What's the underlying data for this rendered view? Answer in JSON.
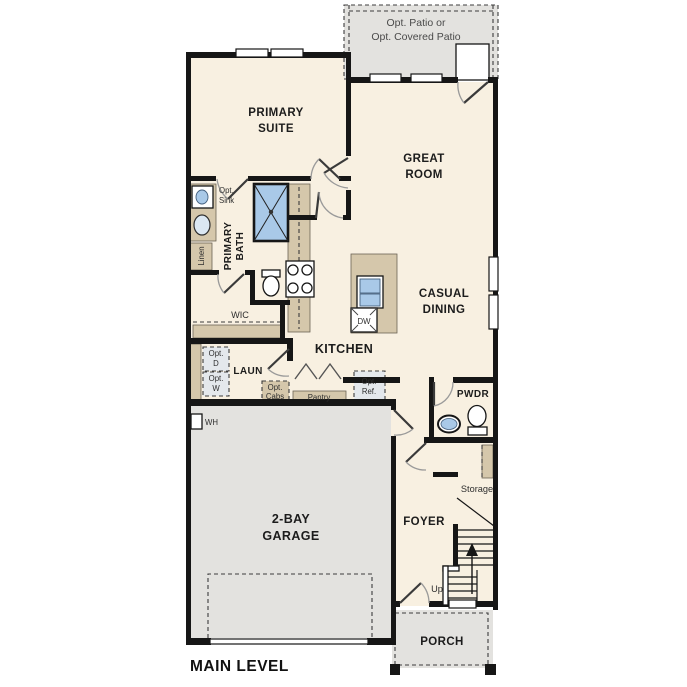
{
  "colors": {
    "wall": "#161616",
    "floor": "#f8f0e1",
    "concrete": "#e3e2df",
    "cabinet": "#d5c7ab",
    "fixture-blue": "#a9c9e8",
    "appliance": "#e4e8ec",
    "label": "#1c1c1c"
  },
  "rooms": {
    "patio": {
      "line1": "Opt. Patio or",
      "line2": "Opt. Covered Patio"
    },
    "primary_suite": {
      "line1": "PRIMARY",
      "line2": "SUITE"
    },
    "great_room": {
      "line1": "GREAT",
      "line2": "ROOM"
    },
    "primary_bath": {
      "line1": "PRIMARY",
      "line2": "BATH"
    },
    "casual_dining": {
      "line1": "CASUAL",
      "line2": "DINING"
    },
    "kitchen": {
      "label": "KITCHEN"
    },
    "wic": {
      "label": "WIC"
    },
    "laundry": {
      "label": "LAUN"
    },
    "pwdr": {
      "label": "PWDR"
    },
    "garage": {
      "line1": "2-BAY",
      "line2": "GARAGE"
    },
    "foyer": {
      "label": "FOYER"
    },
    "storage": {
      "label": "Storage"
    },
    "porch": {
      "label": "PORCH"
    }
  },
  "annotations": {
    "opt_sink": {
      "line1": "Opt.",
      "line2": "Sink"
    },
    "linen": "Linen",
    "opt_d": {
      "line1": "Opt.",
      "line2": "D"
    },
    "opt_w": {
      "line1": "Opt.",
      "line2": "W"
    },
    "opt_cabs": {
      "line1": "Opt.",
      "line2": "Cabs"
    },
    "pantry": "Pantry",
    "opt_ref": {
      "line1": "Opt.",
      "line2": "Ref."
    },
    "dw": "DW",
    "wh": "WH",
    "up": "Up"
  },
  "footer": {
    "label": "MAIN LEVEL"
  }
}
